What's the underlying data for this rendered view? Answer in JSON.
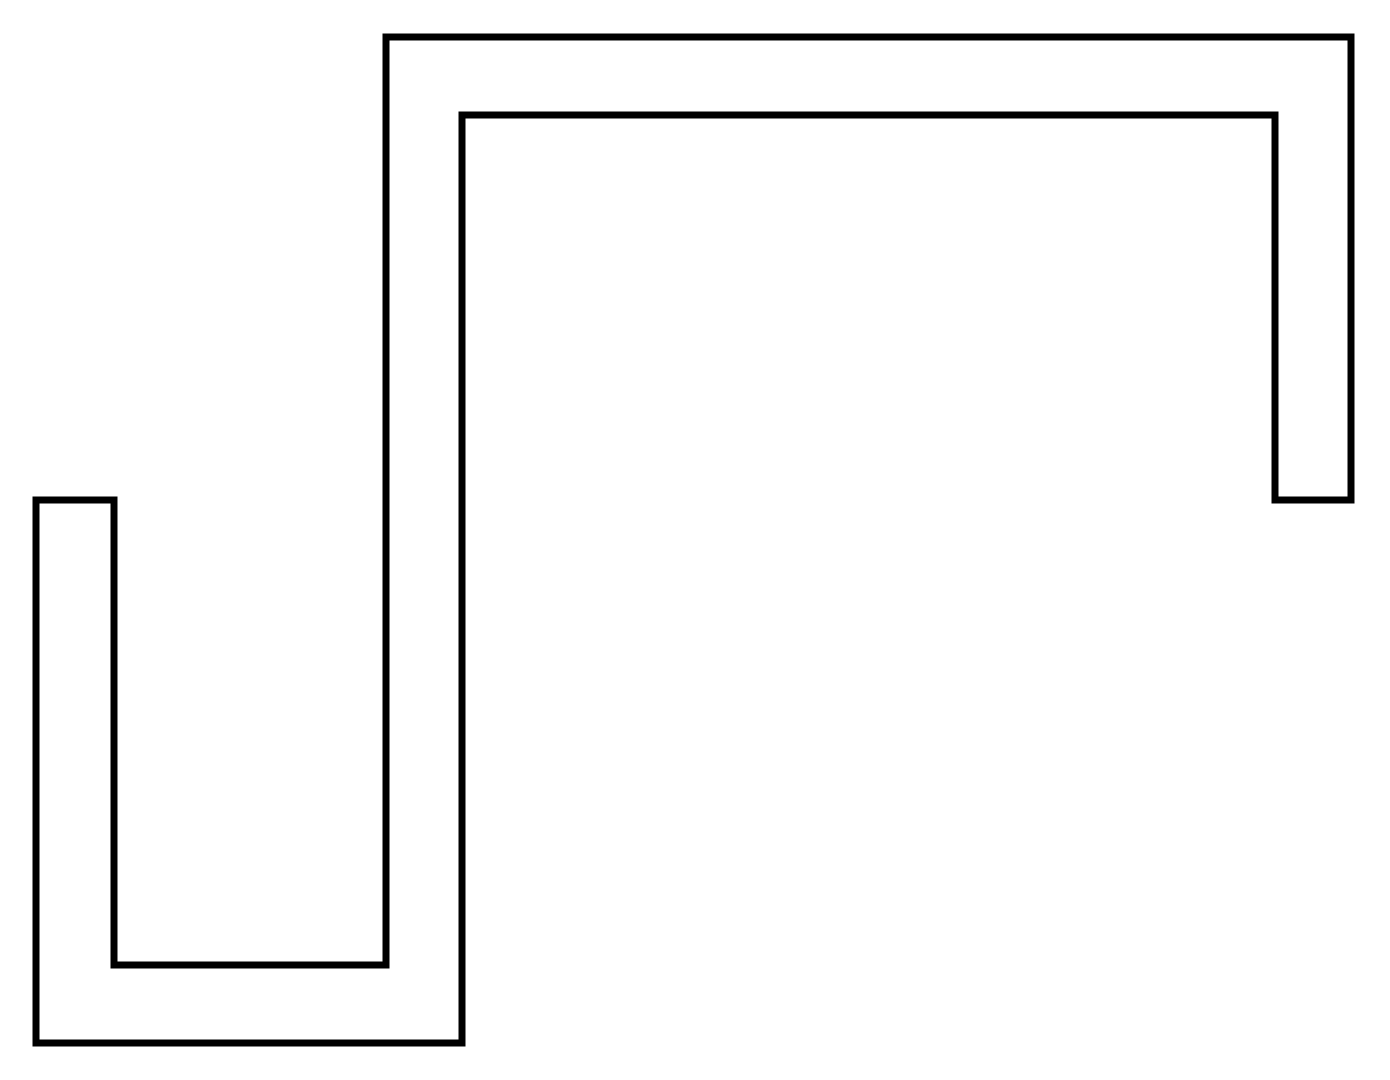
{
  "canvas": {
    "width": 1390,
    "height": 1080,
    "background_color": "#ffffff"
  },
  "shape": {
    "kind": "closed-rectilinear-polygon-outline",
    "description": "serpentine S-shaped thick-path outline",
    "stroke_color": "#000000",
    "stroke_width": 7,
    "fill": "none",
    "points": [
      [
        386,
        37
      ],
      [
        1351,
        37
      ],
      [
        1351,
        500
      ],
      [
        1275,
        500
      ],
      [
        1275,
        115
      ],
      [
        462,
        115
      ],
      [
        462,
        1043
      ],
      [
        36,
        1043
      ],
      [
        36,
        500
      ],
      [
        114,
        500
      ],
      [
        114,
        965
      ],
      [
        386,
        965
      ]
    ]
  }
}
